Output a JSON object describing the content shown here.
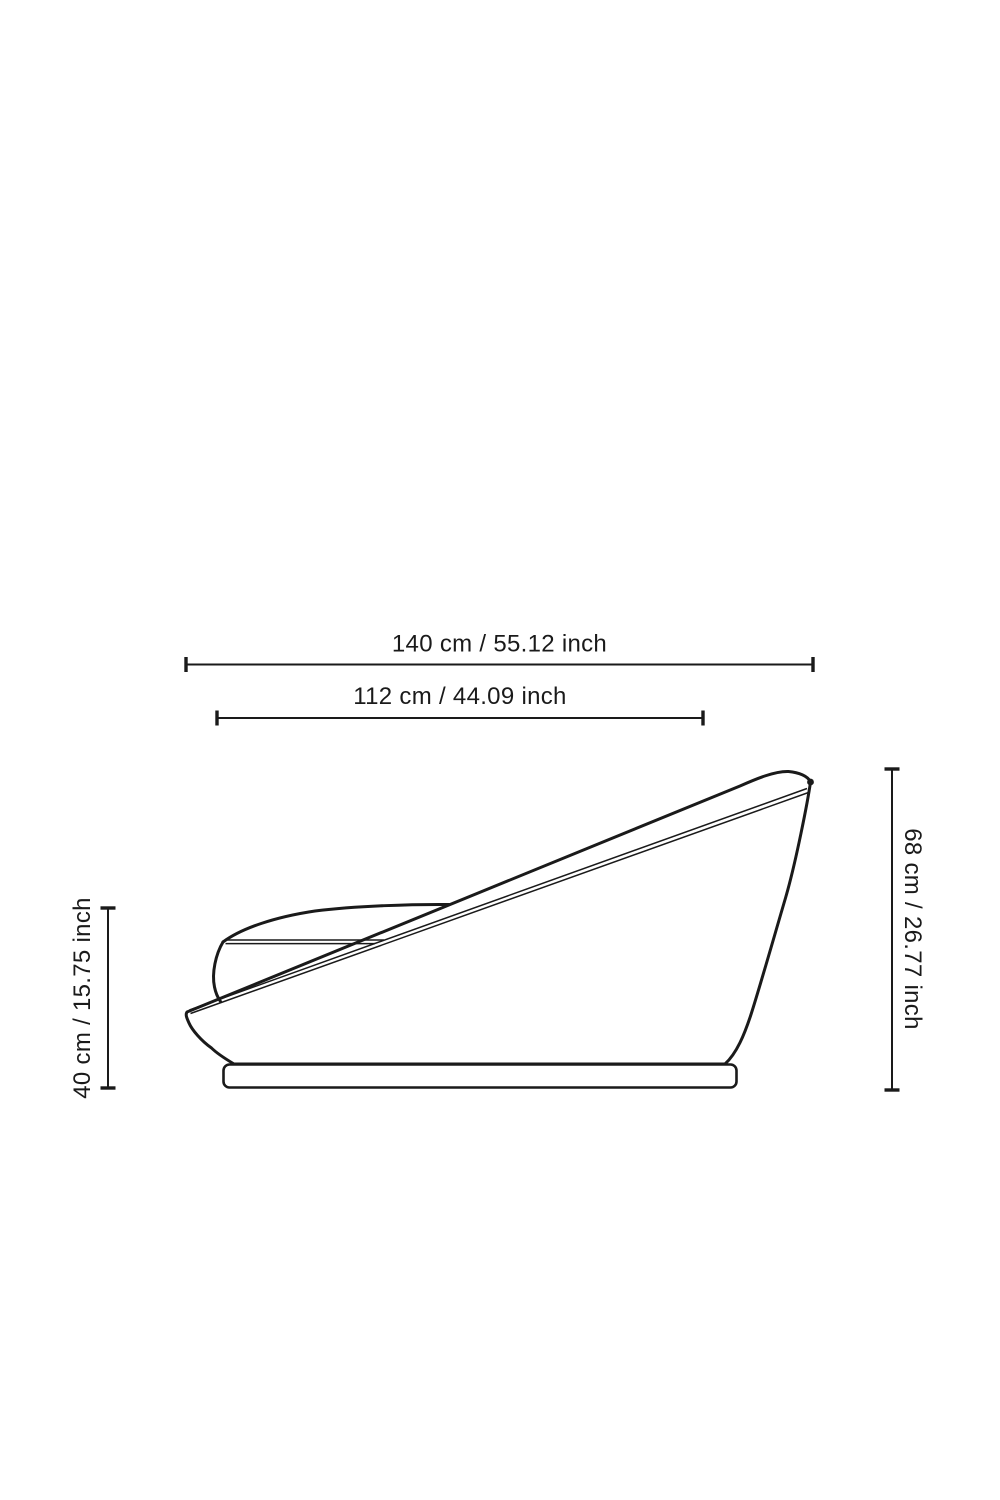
{
  "page": {
    "background": "#ffffff",
    "ink": "#1a1a1a"
  },
  "drawing": {
    "subject": "chaise-lounge-side-view-outline",
    "style": "technical line drawing"
  },
  "measurements": [
    {
      "id": "overall-width",
      "cm": "140",
      "inch": "55.12",
      "label": "140 cm / 55.12 inch",
      "orientation": "horizontal",
      "position": "top-outer"
    },
    {
      "id": "seat-depth",
      "cm": "112",
      "inch": "44.09",
      "label": "112 cm / 44.09 inch",
      "orientation": "horizontal",
      "position": "top-inner"
    },
    {
      "id": "seat-height",
      "cm": "40",
      "inch": "15.75",
      "label": "40 cm / 15.75 inch",
      "orientation": "vertical",
      "position": "left"
    },
    {
      "id": "overall-height",
      "cm": "68",
      "inch": "26.77",
      "label": "68 cm / 26.77 inch",
      "orientation": "vertical",
      "position": "right"
    }
  ]
}
